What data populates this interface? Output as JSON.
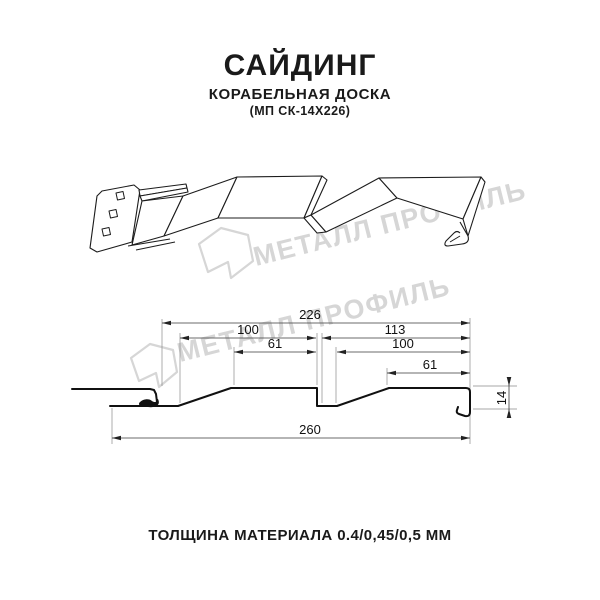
{
  "header": {
    "title": "САЙДИНГ",
    "subtitle": "КОРАБЕЛЬНАЯ ДОСКА",
    "model": "(МП СК-14Х226)"
  },
  "watermark": {
    "brand": "МЕТАЛЛ ПРОФИЛЬ",
    "color": "#d6d6d6"
  },
  "drawing": {
    "type": "technical-profile-diagram",
    "views": [
      "perspective-view",
      "cross-section-with-dimensions"
    ],
    "dimensions_mm": {
      "cover_width": 226,
      "overall_width": 260,
      "left_pitch": 100,
      "right_pitch": 113,
      "left_flat": 61,
      "right_inner_width": 100,
      "right_flat": 61,
      "profile_depth": 14
    },
    "labels": {
      "d226": "226",
      "d100_left": "100",
      "d113": "113",
      "d61_left": "61",
      "d100_right": "100",
      "d61_right": "61",
      "d260": "260",
      "d14": "14"
    }
  },
  "footer": {
    "thickness_note": "ТОЛЩИНА МАТЕРИАЛА 0.4/0,45/0,5 ММ"
  },
  "colors": {
    "ink": "#1a1a1a",
    "line": "#111111",
    "watermark": "#d6d6d6",
    "background": "#ffffff"
  }
}
